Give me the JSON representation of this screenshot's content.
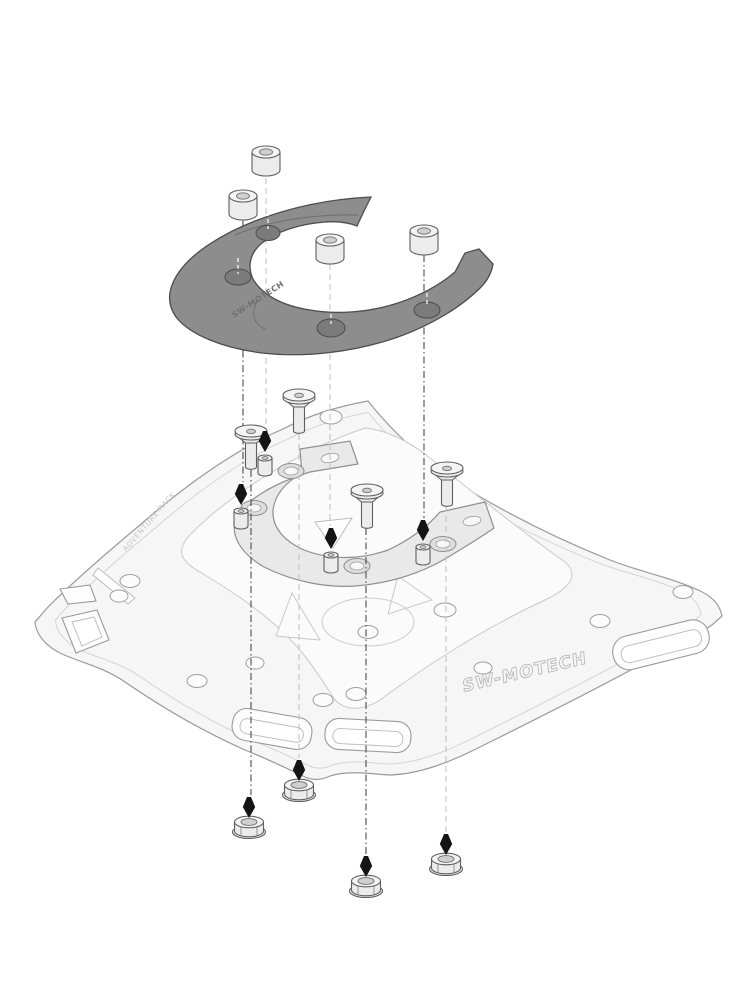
{
  "figure": {
    "kind": "exploded-assembly-diagram",
    "background_color": "#ffffff"
  },
  "markings": {
    "plate_brand": "SW-MOTECH",
    "plate_edge_marking": "ADVENTURE-RACK",
    "ring_marking": "SW-MOTECH"
  },
  "colors": {
    "tank_ring_fill": "#8d8d8d",
    "tank_ring_outline": "#4d4d4d",
    "adapter_ring_fill": "#e9e9ea",
    "rack_plate_fill": "#f6f6f7",
    "plate_outline": "#9a9a9a",
    "insertion_arrow": "#141414",
    "axis_line_dark": "#4a4a4a",
    "axis_line_light": "#c2c2c2"
  },
  "parts": {
    "spacer_sleeves": {
      "name": "spacer-sleeve",
      "count": 4
    },
    "tank_ring": {
      "name": "tank-ring",
      "count": 1
    },
    "countersunk_screws": {
      "name": "countersunk-screw",
      "count": 4
    },
    "studs": {
      "name": "threaded-stud",
      "count": 4
    },
    "adapter_ring": {
      "name": "adapter-ring",
      "count": 1
    },
    "rack_plate": {
      "name": "adventure-rack-plate",
      "count": 1
    },
    "lock_nuts": {
      "name": "flange-lock-nut",
      "count": 4
    }
  }
}
